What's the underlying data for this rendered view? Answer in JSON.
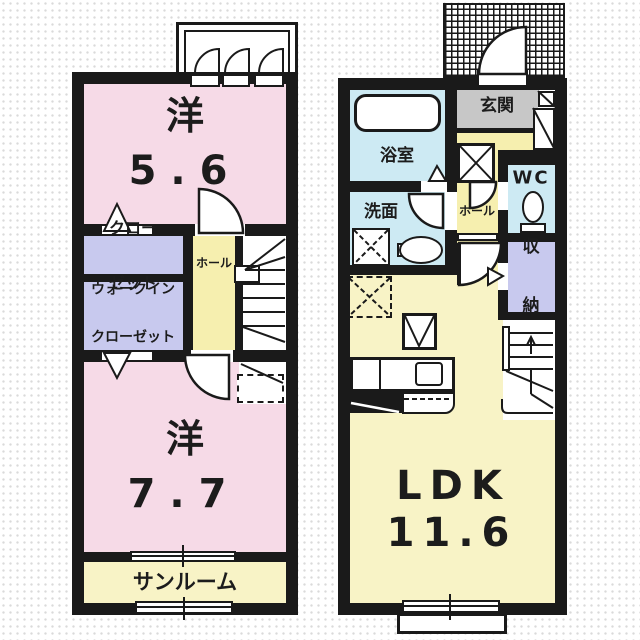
{
  "colors": {
    "wall": "#1a1a1a",
    "room_pink": "#F6DAE7",
    "closet_lavender": "#C8C9EE",
    "hall_yellow": "#F6EFAF",
    "ldk_yellow": "#F8F3C6",
    "water_blue": "#CDEAF3",
    "entrance_gray": "#C7C7C7"
  },
  "left_plan": {
    "bedroom1": {
      "name": "洋",
      "size": "5.6"
    },
    "closet": {
      "line1": "クロー",
      "line2": "ゼット"
    },
    "walkin_closet": {
      "line1": "ウォークイン",
      "line2": "クローゼット"
    },
    "hall": {
      "label": "ホール"
    },
    "bedroom2": {
      "name": "洋",
      "size": "7.7"
    },
    "sunroom": {
      "label": "サンルーム"
    }
  },
  "right_plan": {
    "entrance": {
      "label": "玄関"
    },
    "bathroom": {
      "label": "浴室"
    },
    "washroom": {
      "label": "洗面"
    },
    "wc": {
      "label": "WC"
    },
    "hall": {
      "label": "ホール"
    },
    "storage": {
      "line1": "収",
      "line2": "納"
    },
    "ldk": {
      "name": "LDK",
      "size": "11.6"
    }
  }
}
